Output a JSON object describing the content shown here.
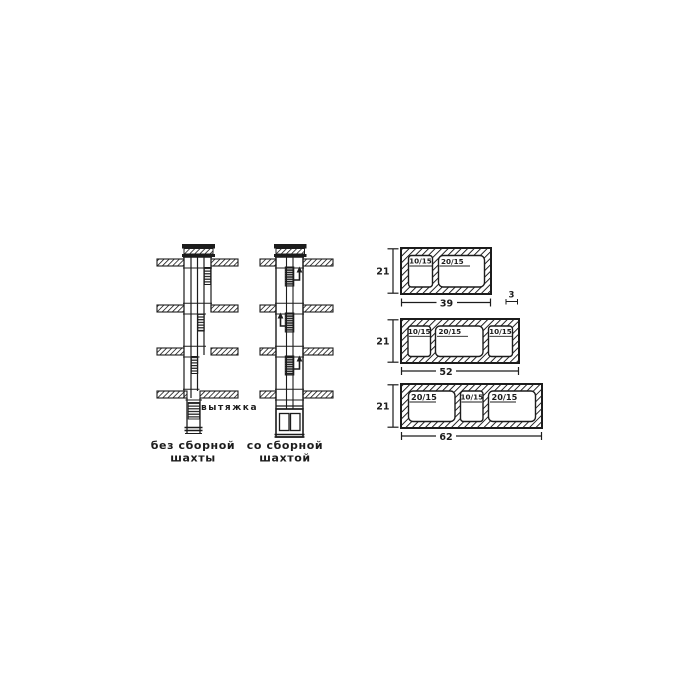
{
  "diagram": {
    "exhaust_label": "вытяжка",
    "captions": {
      "left": [
        "без сборной",
        "шахты"
      ],
      "right": [
        "со сборной",
        "шахтой"
      ]
    }
  },
  "blocks": [
    {
      "height": "21",
      "width": "39",
      "wall_thickness": "3",
      "openings": [
        "10/15",
        "20/15"
      ]
    },
    {
      "height": "21",
      "width": "52",
      "openings": [
        "10/15",
        "20/15",
        "10/15"
      ]
    },
    {
      "height": "21",
      "width": "62",
      "openings": [
        "20/15",
        "10/15",
        "20/15"
      ]
    }
  ],
  "colors": {
    "ink": "#1c1c1c",
    "paper": "#ffffff"
  }
}
